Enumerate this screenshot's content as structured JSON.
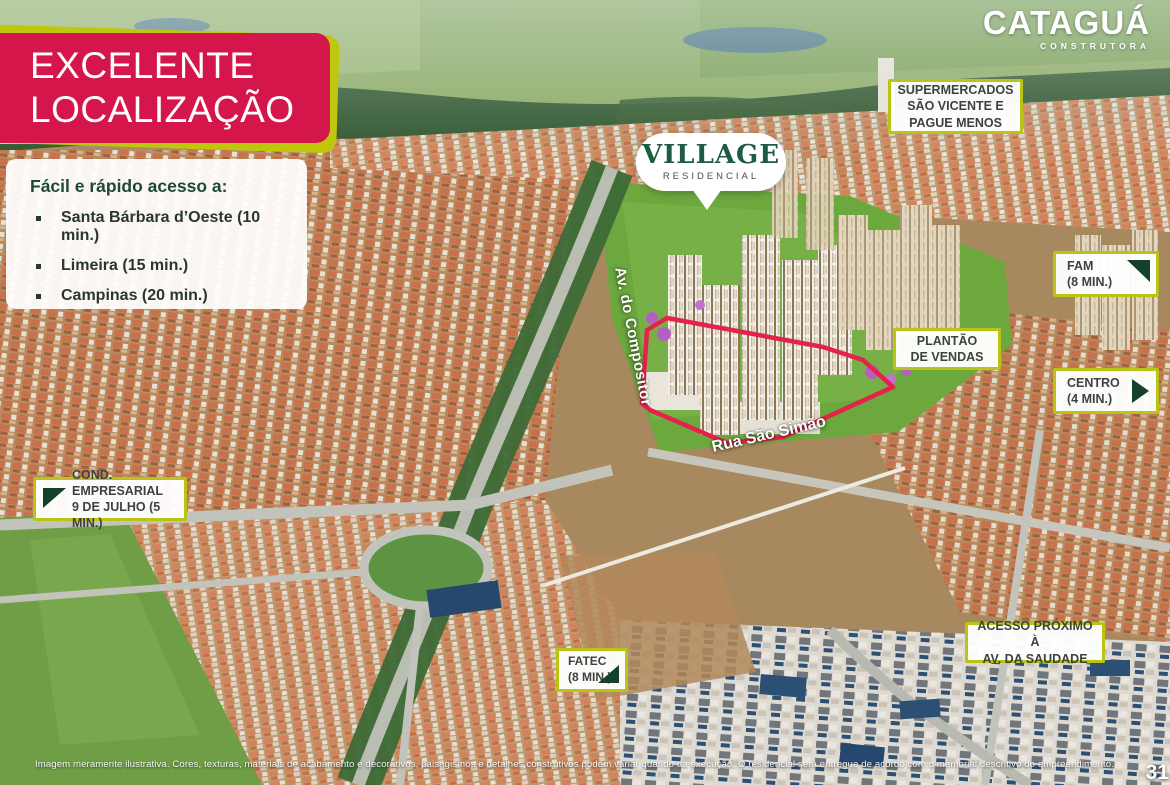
{
  "brand": {
    "logo": "CATAGUÁ",
    "tagline": "CONSTRUTORA"
  },
  "banner": {
    "title": "EXCELENTE\nLOCALIZAÇÃO"
  },
  "access_card": {
    "heading": "Fácil e rápido acesso a:",
    "items": [
      "Santa Bárbara d’Oeste (10 min.)",
      "Limeira (15 min.)",
      "Campinas (20 min.)"
    ]
  },
  "project": {
    "name": "VILLAGE",
    "type": "RESIDENCIAL"
  },
  "map_labels": {
    "supermercados": {
      "text": "SUPERMERCADOS\nSÃO VICENTE E\nPAGUE MENOS"
    },
    "fam": {
      "text": "FAM\n(8 MIN.)",
      "arrow": "ne"
    },
    "plantao": {
      "text": "PLANTÃO\nDE VENDAS"
    },
    "centro": {
      "text": "CENTRO\n(4 MIN.)",
      "arrow": "e"
    },
    "cond_empresarial": {
      "text": "COND. EMPRESARIAL\n9 DE JULHO (5 MIN.)",
      "arrow": "sw"
    },
    "fatec": {
      "text": "FATEC\n(8 MIN.)",
      "arrow": "se"
    },
    "acesso_saudade": {
      "text": "ACESSO PRÓXIMO À\nAV. DA SAUDADE"
    }
  },
  "streets": {
    "av_compositor": "Av. do Compositor",
    "rua_sao_simao": "Rua São Simão"
  },
  "footer": {
    "disclaimer": "Imagem meramente ilustrativa. Cores, texturas, materiais de acabamento e decorativos, paisagismos e detalhes construtivos podem variar quando da execução. O residencial será entregue de acordo com o memorial descritivo do empreendimento.",
    "page": "31"
  },
  "colors": {
    "banner_pink": "#d5164a",
    "accent_lime": "#bfc70d",
    "label_border": "#b9c414",
    "arrow_green": "#16402e",
    "village_green": "#1d5b42",
    "boundary_red": "#e4224b"
  }
}
